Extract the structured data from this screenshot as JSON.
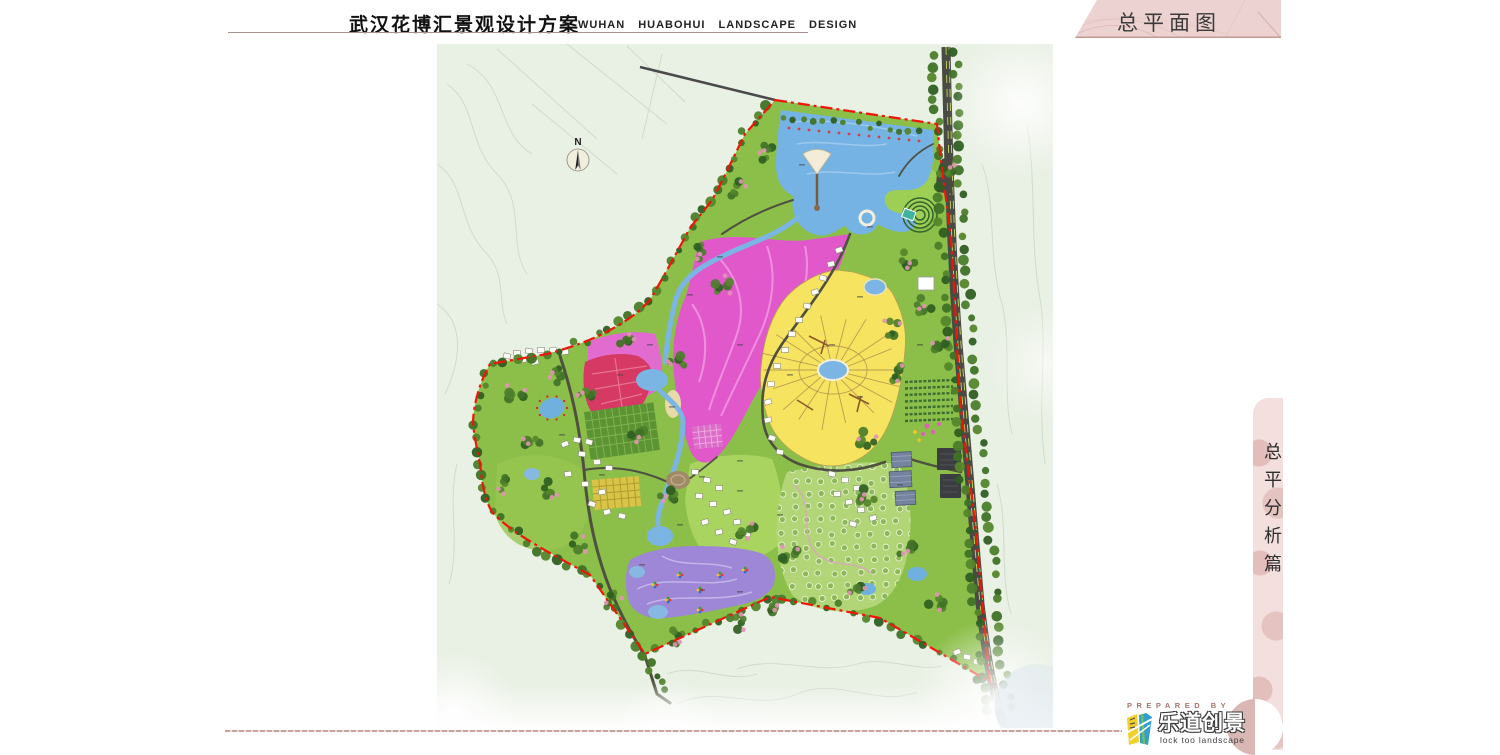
{
  "header": {
    "title_cn": "武汉花博汇景观设计方案",
    "title_en": "WUHAN HUABOHUI LANDSCAPE DESIGN"
  },
  "banner": {
    "label": "总平面图",
    "background": "#ecd3d1",
    "border_color": "#c79792"
  },
  "side_tab": {
    "label": "总平分析篇",
    "background": "#f3dfdd",
    "pattern_color": "#d29c99"
  },
  "map": {
    "north_label": "N",
    "colors": {
      "background": "#e9f0e4",
      "site_green": "#8cbf49",
      "meadow_green": "#a9d45f",
      "lake_blue": "#74b3e3",
      "stream_blue": "#7ab5e4",
      "flower_field_magenta": "#e158cb",
      "flower_field_crimson": "#d63a64",
      "radial_garden_yellow": "#f6e35f",
      "event_zone_purple": "#9d87d6",
      "orchard_green": "#b2d677",
      "boundary_red": "#ee1509",
      "road_dark": "#4a4a44",
      "tree_green": "#3f7226",
      "blossom_pink": "#e293b5"
    }
  },
  "footer": {
    "prepared_by": "PREPARED BY",
    "logo_cn": "乐道创景",
    "logo_en": "lock too landscape",
    "rule_color": "#c9a19d"
  }
}
